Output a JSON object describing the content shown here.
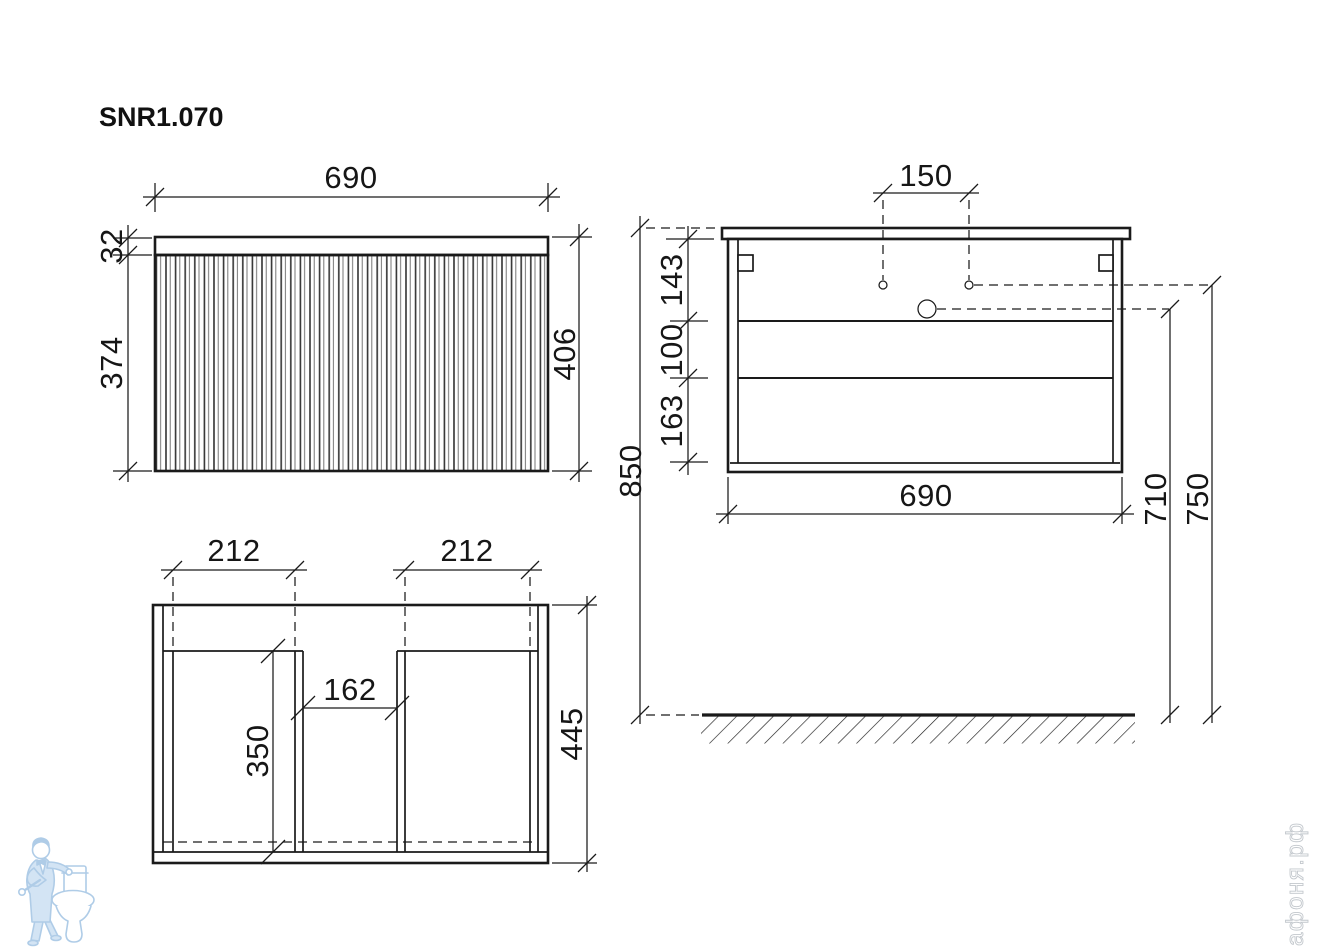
{
  "title": "SNR1.070",
  "watermark": {
    "brand": "афоня.рф",
    "mascot": "plumber-leaning-on-toilet"
  },
  "colors": {
    "line": "#1a1a1a",
    "dim_text": "#161616",
    "mascot_blue_fill": "#c9def2",
    "mascot_blue_outline": "#9cc0e2",
    "brand_gray": "#c3c8cd",
    "background": "#ffffff"
  },
  "front_view": {
    "width": "690",
    "countertop_thickness": "32",
    "facade_height": "374",
    "total_height": "406"
  },
  "plan_view": {
    "left_opening_width": "212",
    "right_opening_width": "212",
    "center_gap": "162",
    "opening_depth": "350",
    "total_depth": "445"
  },
  "side_view": {
    "faucet_hole_spacing": "150",
    "top_to_drawer": "143",
    "drawer_to_drawer": "100",
    "drawer_to_bottom": "163",
    "cabinet_width": "690",
    "mounting_height": "850",
    "drain_height": "710",
    "supply_height": "750"
  }
}
